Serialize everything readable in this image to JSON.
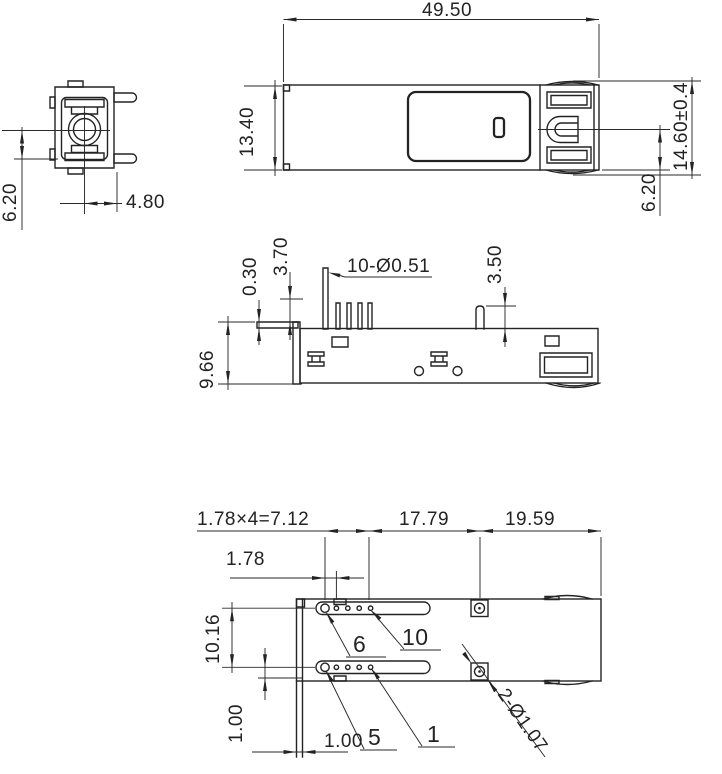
{
  "colors": {
    "ink": "#232323",
    "background": "#ffffff"
  },
  "views": {
    "front": {
      "dims": {
        "port_center_height": "6.20",
        "pin_offset": "4.80"
      }
    },
    "top": {
      "dims": {
        "overall_length": "49.50",
        "body_width": "13.40",
        "overall_width": "14.60±0.4",
        "latch_center_offset": "6.20"
      }
    },
    "side": {
      "dims": {
        "lip_thickness": "0.30",
        "pin_exposed_height": "3.70",
        "pin_spec": "10-Ø0.51",
        "post_height": "3.50",
        "body_height": "9.66"
      }
    },
    "bottom": {
      "dims": {
        "pin_pitch_total": "1.78×4=7.12",
        "pin_to_hole": "17.79",
        "hole_to_end": "19.59",
        "pin_pitch": "1.78",
        "row_spacing": "10.16",
        "row_to_edge": "1.00",
        "flange_thickness": "1.00",
        "hole_spec": "2-Ø1.07"
      },
      "pins": {
        "first_top": "6",
        "last_top": "10",
        "first_bottom": "5",
        "last_bottom": "1"
      }
    }
  }
}
